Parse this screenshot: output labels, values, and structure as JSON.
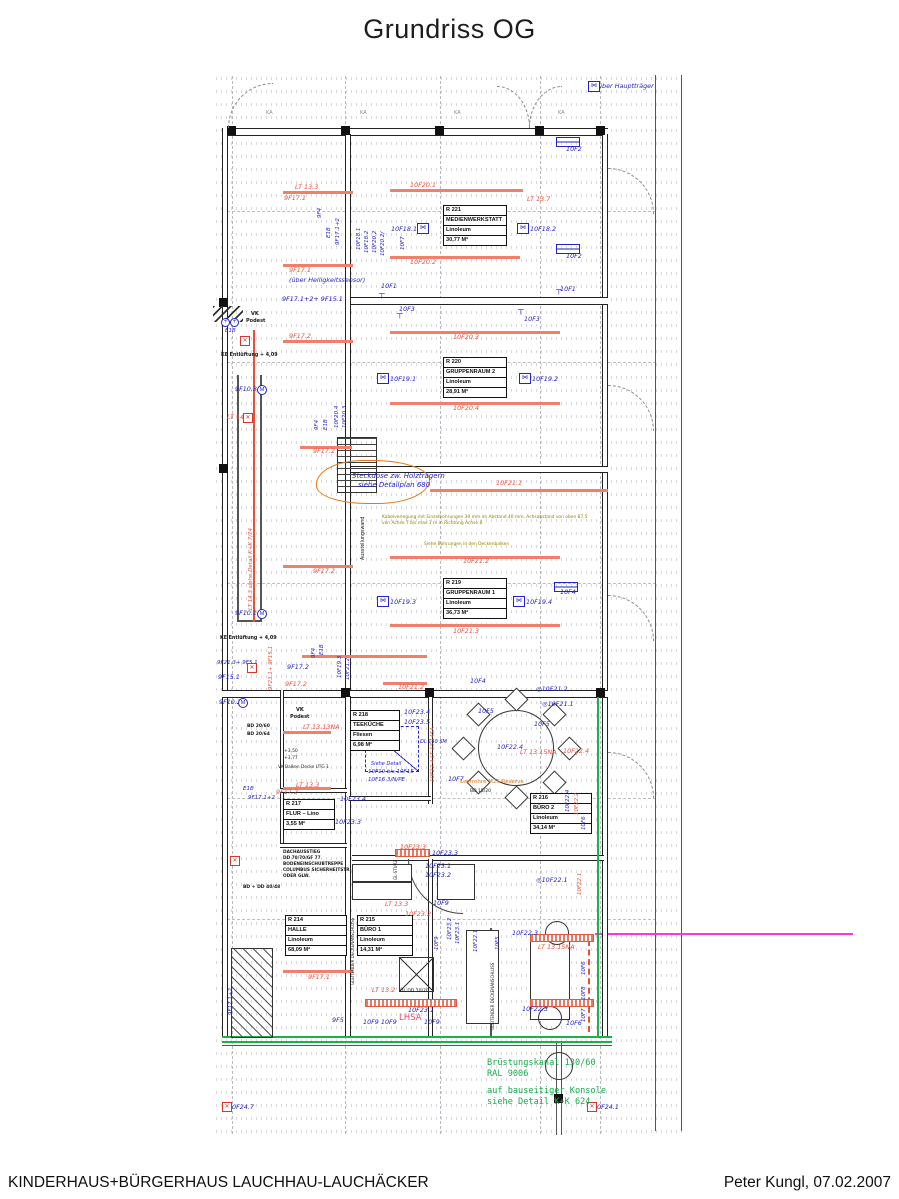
{
  "page": {
    "title": "Grundriss OG",
    "footer_left": "KINDERHAUS+BÜRGERHAUS LAUCHHAU-LAUCHÄCKER",
    "footer_right": "Peter Kungl, 07.02.2007"
  },
  "colors": {
    "cad_blue": "#2323c8",
    "cad_red": "#e8503a",
    "green": "#18a94a",
    "magenta": "#ff35e0",
    "olive": "#938200",
    "orange": "#e07818"
  },
  "green_note": {
    "x": 487,
    "y": 1058,
    "lines": [
      "Brüstungskanal 130/60",
      "RAL 9006",
      "auf bauseitiger Konsole",
      "siehe Detail K+K 624"
    ]
  },
  "rooms": [
    {
      "id": "R 221",
      "rows": [
        "MEDIENWERKSTATT",
        "Linoleum",
        "30,77 M²"
      ],
      "x": 443,
      "y": 205,
      "w": 62
    },
    {
      "id": "R 220",
      "rows": [
        "GRUPPENRAUM 2",
        "Linoleum",
        "28,91 M²"
      ],
      "x": 443,
      "y": 357,
      "w": 62
    },
    {
      "id": "R 219",
      "rows": [
        "GRUPPENRAUM 1",
        "Linoleum",
        "36,73 M²"
      ],
      "x": 443,
      "y": 578,
      "w": 62
    },
    {
      "id": "R 218",
      "rows": [
        "TEEKÜCHE",
        "Fliesen",
        "6,98 M²"
      ],
      "x": 350,
      "y": 710,
      "w": 48
    },
    {
      "id": "R 217",
      "rows": [
        "FLUR – Lino",
        "3,55 M²"
      ],
      "x": 283,
      "y": 799,
      "w": 50
    },
    {
      "id": "R 216",
      "rows": [
        "BÜRO 2",
        "Linoleum",
        "34,14 M²"
      ],
      "x": 530,
      "y": 793,
      "w": 60
    },
    {
      "id": "R 214",
      "rows": [
        "HALLE",
        "Linoleum",
        "68,09 M²"
      ],
      "x": 285,
      "y": 915,
      "w": 60
    },
    {
      "id": "R 215",
      "rows": [
        "BÜRO 1",
        "Linoleum",
        "14,31 M²"
      ],
      "x": 357,
      "y": 915,
      "w": 54
    }
  ],
  "annotations": [
    {
      "t": "über Hauptträger",
      "x": 598,
      "y": 83,
      "c": "b"
    },
    {
      "t": "KA",
      "x": 266,
      "y": 111,
      "c": "gr",
      "fs": 5
    },
    {
      "t": "KA",
      "x": 360,
      "y": 111,
      "c": "gr",
      "fs": 5
    },
    {
      "t": "KA",
      "x": 454,
      "y": 111,
      "c": "gr",
      "fs": 5
    },
    {
      "t": "KA",
      "x": 558,
      "y": 111,
      "c": "gr",
      "fs": 5
    },
    {
      "t": "10F2",
      "x": 566,
      "y": 146,
      "c": "b"
    },
    {
      "t": "LT 13.3",
      "x": 295,
      "y": 184,
      "c": "r"
    },
    {
      "t": "9F17.1",
      "x": 284,
      "y": 195,
      "c": "r"
    },
    {
      "t": "10F20.1",
      "x": 410,
      "y": 182,
      "c": "r"
    },
    {
      "t": "LT 13.7",
      "x": 527,
      "y": 196,
      "c": "r"
    },
    {
      "t": "9F4",
      "x": 318,
      "y": 218,
      "c": "b",
      "rot": -90,
      "fs": 5.5
    },
    {
      "t": "E1B",
      "x": 327,
      "y": 238,
      "c": "b",
      "rot": -90,
      "fs": 5.5
    },
    {
      "t": "9F17.1+2",
      "x": 336,
      "y": 245,
      "c": "b",
      "rot": -90,
      "fs": 5.5
    },
    {
      "t": "10F18.1",
      "x": 357,
      "y": 250,
      "c": "b",
      "rot": -90,
      "fs": 5.5
    },
    {
      "t": "10F18.2",
      "x": 365,
      "y": 253,
      "c": "b",
      "rot": -90,
      "fs": 5.5
    },
    {
      "t": "10F20.2",
      "x": 373,
      "y": 253,
      "c": "b",
      "rot": -90,
      "fs": 5.5
    },
    {
      "t": "10F20.2/",
      "x": 381,
      "y": 256,
      "c": "b",
      "rot": -90,
      "fs": 5.5
    },
    {
      "t": "10F7",
      "x": 401,
      "y": 250,
      "c": "b",
      "rot": -90,
      "fs": 5.5
    },
    {
      "t": "10F18.1",
      "x": 391,
      "y": 226,
      "c": "b"
    },
    {
      "t": "10F18.2",
      "x": 530,
      "y": 226,
      "c": "b"
    },
    {
      "t": "10F2",
      "x": 566,
      "y": 253,
      "c": "b"
    },
    {
      "t": "10F20.2",
      "x": 410,
      "y": 259,
      "c": "r"
    },
    {
      "t": "9F17.1",
      "x": 289,
      "y": 267,
      "c": "r"
    },
    {
      "t": "(über Helligkeitssensor)",
      "x": 289,
      "y": 277,
      "c": "b"
    },
    {
      "t": "9F17.1+2+ 9F15.1",
      "x": 282,
      "y": 296,
      "c": "b"
    },
    {
      "t": "10F1",
      "x": 381,
      "y": 283,
      "c": "b"
    },
    {
      "t": "10F3",
      "x": 399,
      "y": 306,
      "c": "b"
    },
    {
      "t": "10F1",
      "x": 560,
      "y": 286,
      "c": "b"
    },
    {
      "t": "10F3",
      "x": 524,
      "y": 316,
      "c": "b"
    },
    {
      "t": "9F17.2",
      "x": 289,
      "y": 333,
      "c": "r"
    },
    {
      "t": "10F20.3",
      "x": 453,
      "y": 334,
      "c": "r"
    },
    {
      "t": "KE Entlüftung + 4,09",
      "x": 221,
      "y": 354,
      "c": "k",
      "fs": 4.8,
      "b": 1
    },
    {
      "t": "VK",
      "x": 251,
      "y": 312,
      "c": "k",
      "fs": 5,
      "b": 1
    },
    {
      "t": "Podest",
      "x": 246,
      "y": 319,
      "c": "k",
      "fs": 5,
      "b": 1
    },
    {
      "t": "E1B",
      "x": 225,
      "y": 329,
      "c": "b",
      "fs": 5.5
    },
    {
      "t": "9F10.3",
      "x": 235,
      "y": 386,
      "c": "b"
    },
    {
      "t": "LT 14.11",
      "x": 227,
      "y": 414,
      "c": "r"
    },
    {
      "t": "LT 14.3  siehe Detail K+K 7/74",
      "x": 249,
      "y": 610,
      "c": "r",
      "rot": -90,
      "fs": 5.5
    },
    {
      "t": "10F19.1",
      "x": 390,
      "y": 376,
      "c": "b"
    },
    {
      "t": "10F19.2",
      "x": 532,
      "y": 376,
      "c": "b"
    },
    {
      "t": "10F20.4",
      "x": 453,
      "y": 405,
      "c": "r"
    },
    {
      "t": "9F4",
      "x": 315,
      "y": 430,
      "c": "b",
      "rot": -90,
      "fs": 5.5
    },
    {
      "t": "E1B",
      "x": 324,
      "y": 430,
      "c": "b",
      "rot": -90,
      "fs": 5.5
    },
    {
      "t": "10F20.4",
      "x": 335,
      "y": 428,
      "c": "b",
      "rot": -90,
      "fs": 5.5
    },
    {
      "t": "10F20.3",
      "x": 343,
      "y": 428,
      "c": "b",
      "rot": -90,
      "fs": 5.5
    },
    {
      "t": "9F17.2",
      "x": 313,
      "y": 448,
      "c": "r"
    },
    {
      "t": "Steckdose zw. Holzträgern",
      "x": 352,
      "y": 473,
      "c": "b",
      "fs": 7
    },
    {
      "t": "siehe Detailplan 680",
      "x": 358,
      "y": 482,
      "c": "b",
      "fs": 7
    },
    {
      "t": "10F21.1",
      "x": 496,
      "y": 480,
      "c": "r"
    },
    {
      "t": "Kabelverlegung mit Einzelbohrungen 30 mm im Abstand 40 mm, Achsabstand von oben 87,5",
      "x": 382,
      "y": 516,
      "c": "o",
      "fs": 4.4
    },
    {
      "t": "von Achse 7 bis max 1 m in Richtung Achse 8",
      "x": 382,
      "y": 522,
      "c": "o",
      "fs": 4.4
    },
    {
      "t": "Siehe Bohrungen in den Deckenbalken",
      "x": 424,
      "y": 543,
      "c": "o",
      "fs": 4.4
    },
    {
      "t": "Ausstellungswand",
      "x": 362,
      "y": 560,
      "c": "k",
      "rot": -90,
      "fs": 4.8
    },
    {
      "t": "10F21.2",
      "x": 463,
      "y": 558,
      "c": "r"
    },
    {
      "t": "9F17.2",
      "x": 313,
      "y": 568,
      "c": "r"
    },
    {
      "t": "10F4",
      "x": 560,
      "y": 589,
      "c": "b"
    },
    {
      "t": "10F19.3",
      "x": 390,
      "y": 599,
      "c": "b"
    },
    {
      "t": "10F19.4",
      "x": 526,
      "y": 599,
      "c": "b"
    },
    {
      "t": "10F21.3",
      "x": 453,
      "y": 628,
      "c": "r"
    },
    {
      "t": "9F10.1",
      "x": 235,
      "y": 610,
      "c": "b"
    },
    {
      "t": "KE Entlüftung + 4,09",
      "x": 220,
      "y": 637,
      "c": "k",
      "fs": 4.8,
      "b": 1
    },
    {
      "t": "9F21.3+ 9F5.1",
      "x": 217,
      "y": 661,
      "c": "b",
      "fs": 5.5
    },
    {
      "t": "9F15.1",
      "x": 218,
      "y": 674,
      "c": "b"
    },
    {
      "t": "9F10.2",
      "x": 219,
      "y": 699,
      "c": "b"
    },
    {
      "t": "9F23.1+ 9F15.1",
      "x": 269,
      "y": 690,
      "c": "r",
      "rot": -90,
      "fs": 5.5
    },
    {
      "t": "9F17.2",
      "x": 287,
      "y": 664,
      "c": "b"
    },
    {
      "t": "9F17.2",
      "x": 285,
      "y": 681,
      "c": "r"
    },
    {
      "t": "E1B",
      "x": 320,
      "y": 655,
      "c": "b",
      "rot": -90,
      "fs": 5.5
    },
    {
      "t": "9F4",
      "x": 312,
      "y": 658,
      "c": "b",
      "rot": -90,
      "fs": 5.5
    },
    {
      "t": "10F19.3",
      "x": 338,
      "y": 678,
      "c": "b",
      "rot": -90,
      "fs": 5.5
    },
    {
      "t": "10F21.2",
      "x": 346,
      "y": 680,
      "c": "b",
      "rot": -90,
      "fs": 5.5
    },
    {
      "t": "10F21.2",
      "x": 398,
      "y": 684,
      "c": "r"
    },
    {
      "t": "10F4",
      "x": 470,
      "y": 678,
      "c": "b"
    },
    {
      "t": "◎10F21.2",
      "x": 536,
      "y": 686,
      "c": "b"
    },
    {
      "t": "◎10F21.1",
      "x": 542,
      "y": 701,
      "c": "b"
    },
    {
      "t": "10F5",
      "x": 478,
      "y": 708,
      "c": "b"
    },
    {
      "t": "10F5",
      "x": 534,
      "y": 721,
      "c": "b"
    },
    {
      "t": "10F23.4",
      "x": 404,
      "y": 709,
      "c": "b"
    },
    {
      "t": "10F23.5",
      "x": 404,
      "y": 719,
      "c": "b"
    },
    {
      "t": "LT 13.13NA",
      "x": 303,
      "y": 724,
      "c": "r"
    },
    {
      "t": "DL 140 SM",
      "x": 420,
      "y": 740,
      "c": "b",
      "fs": 5
    },
    {
      "t": "10F22.4 LT 13.14SA",
      "x": 431,
      "y": 782,
      "c": "r",
      "rot": -90,
      "fs": 5.5
    },
    {
      "t": "10F22.4",
      "x": 497,
      "y": 744,
      "c": "b"
    },
    {
      "t": "LT 13.15NA",
      "x": 520,
      "y": 749,
      "c": "r"
    },
    {
      "t": "10F22.4",
      "x": 563,
      "y": 748,
      "c": "r"
    },
    {
      "t": "Siehe Detail",
      "x": 371,
      "y": 762,
      "c": "b",
      "fs": 5
    },
    {
      "t": "10F10 bis 10F15",
      "x": 368,
      "y": 770,
      "c": "b",
      "fs": 5.5
    },
    {
      "t": "10F16 3/N/PE",
      "x": 368,
      "y": 778,
      "c": "b",
      "fs": 5.5
    },
    {
      "t": "10F7",
      "x": 448,
      "y": 776,
      "c": "b"
    },
    {
      "t": "Leerrohre M25 Reserve",
      "x": 460,
      "y": 780,
      "c": "or",
      "fs": 5.5
    },
    {
      "t": "BD 15/20",
      "x": 470,
      "y": 790,
      "c": "k",
      "fs": 4.5
    },
    {
      "t": "10F22.4",
      "x": 566,
      "y": 812,
      "c": "b",
      "rot": -90,
      "fs": 5.5
    },
    {
      "t": "10F22.2",
      "x": 575,
      "y": 815,
      "c": "r",
      "rot": -90,
      "fs": 5.5
    },
    {
      "t": "10F6",
      "x": 582,
      "y": 830,
      "c": "b",
      "rot": -90,
      "fs": 5.5
    },
    {
      "t": "+3,50",
      "x": 284,
      "y": 750,
      "c": "k",
      "fs": 4.5
    },
    {
      "t": "+3,77",
      "x": 284,
      "y": 757,
      "c": "k",
      "fs": 4.5
    },
    {
      "t": "VK Balken Decke UTG 1",
      "x": 278,
      "y": 766,
      "c": "k",
      "fs": 4.3
    },
    {
      "t": "LT 13.3",
      "x": 296,
      "y": 782,
      "c": "r"
    },
    {
      "t": "E1B",
      "x": 243,
      "y": 787,
      "c": "b",
      "fs": 5.5
    },
    {
      "t": "9F17.1+2",
      "x": 248,
      "y": 796,
      "c": "b",
      "fs": 5.5
    },
    {
      "t": "VK",
      "x": 296,
      "y": 708,
      "c": "k",
      "fs": 5,
      "b": 1
    },
    {
      "t": "Podest",
      "x": 290,
      "y": 715,
      "c": "k",
      "fs": 5,
      "b": 1
    },
    {
      "t": "BD 20/60",
      "x": 247,
      "y": 725,
      "c": "k",
      "fs": 4.5,
      "b": 1
    },
    {
      "t": "BD 20/64",
      "x": 247,
      "y": 733,
      "c": "k",
      "fs": 4.5,
      "b": 1
    },
    {
      "t": "9F17.2",
      "x": 276,
      "y": 789,
      "c": "r"
    },
    {
      "t": "10F23.4",
      "x": 340,
      "y": 796,
      "c": "b"
    },
    {
      "t": "10F23.3",
      "x": 335,
      "y": 819,
      "c": "b"
    },
    {
      "t": "DACHAUSSTIEG",
      "x": 283,
      "y": 851,
      "c": "k",
      "fs": 4.3,
      "b": 1
    },
    {
      "t": "DD 70/70/GF 77",
      "x": 283,
      "y": 857,
      "c": "k",
      "fs": 4.3,
      "b": 1
    },
    {
      "t": "BODENEINSCHUBTREPPE",
      "x": 283,
      "y": 863,
      "c": "k",
      "fs": 4.3,
      "b": 1
    },
    {
      "t": "COLUMBUS SICHERHEITSTR.",
      "x": 283,
      "y": 869,
      "c": "k",
      "fs": 4.3,
      "b": 1
    },
    {
      "t": "ODER GLW.",
      "x": 283,
      "y": 875,
      "c": "k",
      "fs": 4.3,
      "b": 1
    },
    {
      "t": "BD + DD 40/48",
      "x": 243,
      "y": 886,
      "c": "k",
      "fs": 4.5,
      "b": 1
    },
    {
      "t": "10F23.3",
      "x": 400,
      "y": 844,
      "c": "r"
    },
    {
      "t": "10F23.3",
      "x": 432,
      "y": 850,
      "c": "b"
    },
    {
      "t": "GL-STURZ",
      "x": 394,
      "y": 880,
      "c": "k",
      "rot": -90,
      "fs": 4
    },
    {
      "t": "10F23.1",
      "x": 425,
      "y": 863,
      "c": "b"
    },
    {
      "t": "10F23.2",
      "x": 425,
      "y": 872,
      "c": "b"
    },
    {
      "t": "LT 13.3",
      "x": 385,
      "y": 901,
      "c": "r"
    },
    {
      "t": "10F9",
      "x": 433,
      "y": 900,
      "c": "b"
    },
    {
      "t": "10F23.2",
      "x": 405,
      "y": 911,
      "c": "r"
    },
    {
      "t": "10F23.2",
      "x": 448,
      "y": 940,
      "c": "b",
      "rot": -90,
      "fs": 5.5
    },
    {
      "t": "10F23.1",
      "x": 456,
      "y": 944,
      "c": "b",
      "rot": -90,
      "fs": 5.5
    },
    {
      "t": "10F9",
      "x": 435,
      "y": 950,
      "c": "b",
      "rot": -90,
      "fs": 5.5
    },
    {
      "t": "10F22.1",
      "x": 474,
      "y": 952,
      "c": "b",
      "rot": -90,
      "fs": 5.5
    },
    {
      "t": "10F5",
      "x": 496,
      "y": 950,
      "c": "b",
      "rot": -90,
      "fs": 5.5
    },
    {
      "t": "10F22.1",
      "x": 578,
      "y": 895,
      "c": "r",
      "rot": -90,
      "fs": 5.5
    },
    {
      "t": "◎10F22.1",
      "x": 536,
      "y": 877,
      "c": "b"
    },
    {
      "t": "GLEITENDER DECKENANSCHLUSS",
      "x": 351,
      "y": 985,
      "c": "k",
      "rot": -90,
      "fs": 4
    },
    {
      "t": "GLEITENDER DECKENANSCHLUSS",
      "x": 491,
      "y": 1030,
      "c": "k",
      "rot": -90,
      "fs": 4
    },
    {
      "t": "10F22.3",
      "x": 512,
      "y": 930,
      "c": "b"
    },
    {
      "t": "LT 13.15NA",
      "x": 538,
      "y": 944,
      "c": "r"
    },
    {
      "t": "10F22.3",
      "x": 522,
      "y": 1006,
      "c": "b"
    },
    {
      "t": "10F6",
      "x": 582,
      "y": 975,
      "c": "b",
      "rot": -90,
      "fs": 5.5
    },
    {
      "t": "10F8",
      "x": 582,
      "y": 1000,
      "c": "b",
      "rot": -90,
      "fs": 5.5
    },
    {
      "t": "10F7",
      "x": 582,
      "y": 1022,
      "c": "b",
      "rot": -90,
      "fs": 5.5
    },
    {
      "t": "10F6",
      "x": 566,
      "y": 1020,
      "c": "b"
    },
    {
      "t": "9F17.1",
      "x": 308,
      "y": 974,
      "c": "r"
    },
    {
      "t": "LT 13.2",
      "x": 372,
      "y": 987,
      "c": "r"
    },
    {
      "t": "DL DD 70/70",
      "x": 400,
      "y": 990,
      "c": "k",
      "fs": 4.5
    },
    {
      "t": "10F23.1",
      "x": 408,
      "y": 1007,
      "c": "b"
    },
    {
      "t": "9F5",
      "x": 332,
      "y": 1017,
      "c": "b"
    },
    {
      "t": "10F9 10F9",
      "x": 363,
      "y": 1019,
      "c": "b"
    },
    {
      "t": "LHSA",
      "x": 399,
      "y": 1014,
      "c": "p",
      "fs": 8.5
    },
    {
      "t": "10F9",
      "x": 424,
      "y": 1019,
      "c": "b"
    },
    {
      "t": "9F17.1+2",
      "x": 229,
      "y": 1015,
      "c": "b",
      "rot": -90,
      "fs": 5.5
    },
    {
      "t": "0F24.7",
      "x": 232,
      "y": 1104,
      "c": "b"
    },
    {
      "t": "0F24.1",
      "x": 597,
      "y": 1104,
      "c": "b"
    }
  ],
  "icons": [
    {
      "k": "window",
      "x": 588,
      "y": 81
    },
    {
      "k": "window",
      "x": 417,
      "y": 223
    },
    {
      "k": "window",
      "x": 517,
      "y": 223
    },
    {
      "k": "window",
      "x": 377,
      "y": 373
    },
    {
      "k": "window",
      "x": 519,
      "y": 373
    },
    {
      "k": "window",
      "x": 377,
      "y": 596
    },
    {
      "k": "window",
      "x": 513,
      "y": 596
    },
    {
      "k": "radiator",
      "x": 556,
      "y": 137
    },
    {
      "k": "radiator",
      "x": 556,
      "y": 244
    },
    {
      "k": "radiator",
      "x": 554,
      "y": 582
    },
    {
      "k": "tsym",
      "x": 379,
      "y": 290
    },
    {
      "k": "tsym",
      "x": 397,
      "y": 310
    },
    {
      "k": "tsym",
      "x": 518,
      "y": 306
    },
    {
      "k": "tsym",
      "x": 556,
      "y": 286
    },
    {
      "k": "motor",
      "x": 257,
      "y": 385
    },
    {
      "k": "motor",
      "x": 257,
      "y": 609
    },
    {
      "k": "motor",
      "x": 238,
      "y": 698
    },
    {
      "k": "oplus",
      "x": 221,
      "y": 318
    },
    {
      "k": "oplus",
      "x": 230,
      "y": 318
    },
    {
      "k": "xbox",
      "x": 240,
      "y": 336
    },
    {
      "k": "xbox",
      "x": 243,
      "y": 413
    },
    {
      "k": "xbox",
      "x": 247,
      "y": 663
    },
    {
      "k": "xbox",
      "x": 230,
      "y": 856
    },
    {
      "k": "xbox",
      "x": 222,
      "y": 1102
    },
    {
      "k": "xbox",
      "x": 587,
      "y": 1102
    }
  ]
}
